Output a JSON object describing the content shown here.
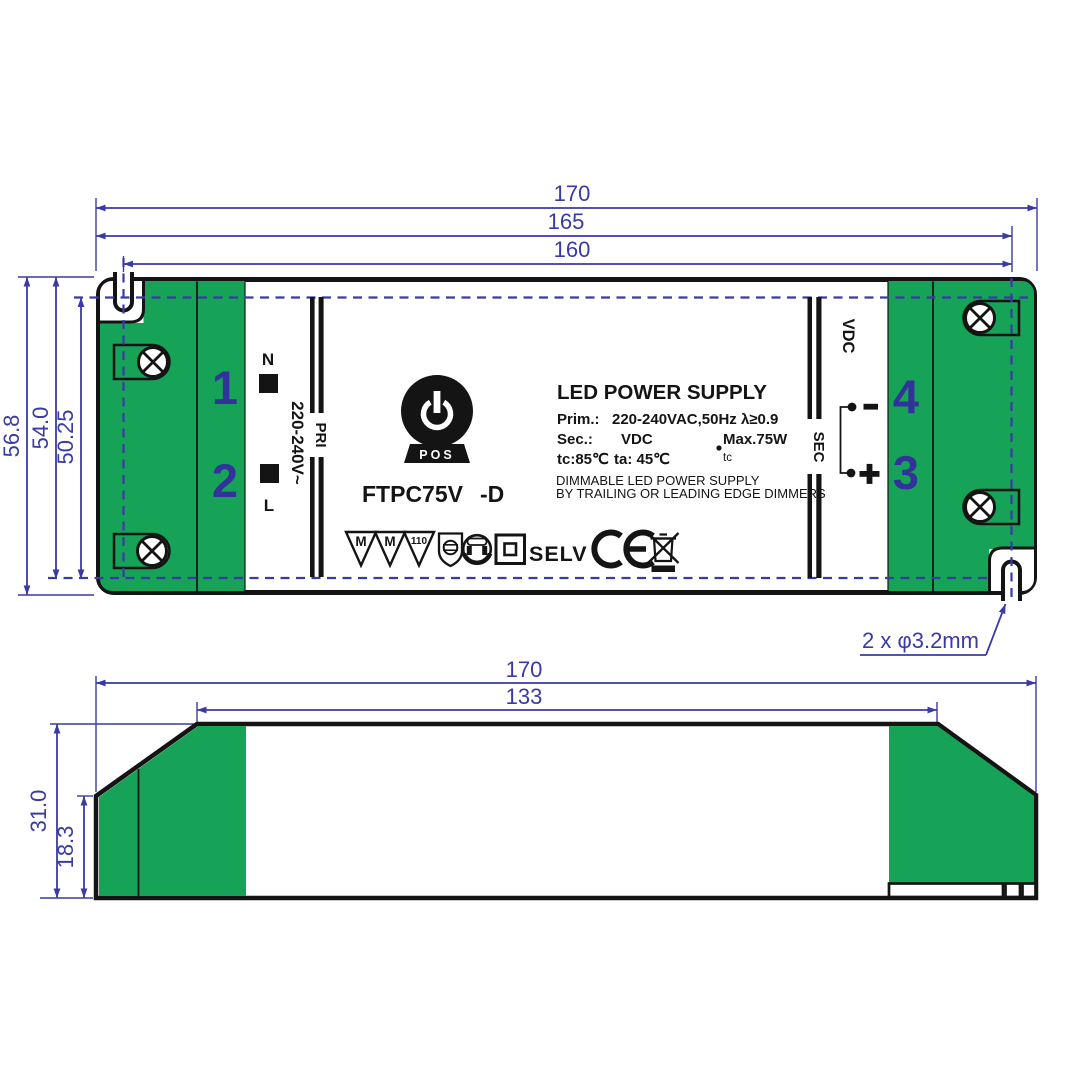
{
  "colors": {
    "green": "#16A257",
    "dimension_blue": "#3A3AA6",
    "numbers_blue": "#32329B",
    "outline_black": "#141414"
  },
  "top_view": {
    "dims": {
      "outer_width": "170",
      "edge_to_slot_width": "165",
      "slot_to_slot_width": "160",
      "outer_height": "56.8",
      "edge_to_slot_height": "54.0",
      "slot_to_slot_height": "50.25"
    },
    "hole_note": "2 x φ3.2mm",
    "corner_numbers": {
      "n1": "1",
      "n2": "2",
      "n3": "3",
      "n4": "4"
    },
    "terminals": {
      "neutral": "N",
      "line": "L",
      "pri": "PRI",
      "sec": "SEC",
      "vdc": "VDC",
      "input_voltage": "220-240V~"
    },
    "label": {
      "title": "LED POWER SUPPLY",
      "prim_label": "Prim.:",
      "prim_value": "220-240VAC,50Hz λ≥0.9",
      "sec_label": "Sec.:",
      "sec_value": "VDC",
      "max_power": "Max.75W",
      "tc": "tc:85℃",
      "ta": "ta: 45℃",
      "tc_point": "tc",
      "dimmable_line1": "DIMMABLE LED POWER SUPPLY",
      "dimmable_line2": "BY TRAILING OR LEADING EDGE DIMMERS",
      "model": "FTPC75V",
      "model_suffix": "-D",
      "selv": "SELV",
      "logo_text": "POS",
      "triangle1": "M",
      "triangle2": "M",
      "triangle3": "110"
    }
  },
  "side_view": {
    "dims": {
      "outer_width": "170",
      "top_width": "133",
      "outer_height": "31.0",
      "left_edge_height": "18.3"
    }
  }
}
